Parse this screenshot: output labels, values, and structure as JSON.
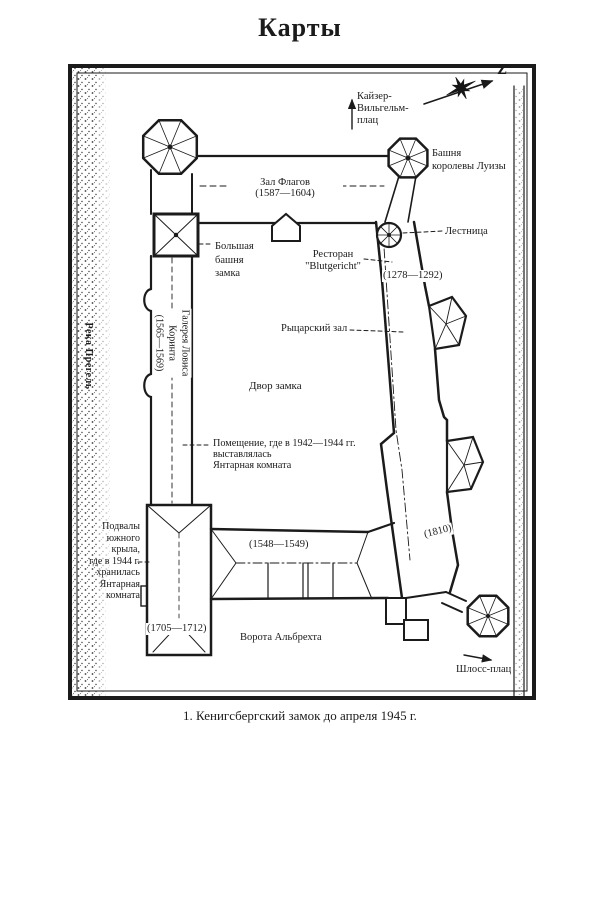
{
  "page": {
    "title": "Карты",
    "caption": "1. Кенигсбергский замок до апреля 1945 г."
  },
  "map": {
    "ink_color": "#1b1b1b",
    "paper_color": "#ffffff",
    "compass": {
      "north_letter": "Z"
    },
    "labels": {
      "kaiser_wilhelm_platz": "Кайзер-\nВильгельм-\nплац",
      "queen_louise_tower": "Башня\nкоролевы Луизы",
      "flags_hall": "Зал Флагов\n(1587—1604)",
      "big_castle_tower": "Большая\nбашня\nзамка",
      "staircase": "Лестница",
      "restaurant_blutgericht": "Ресторан\n\"Blutgericht\"",
      "years_1278_1292": "(1278—1292)",
      "knights_hall": "Рыцарский зал",
      "lovis_corinth_gallery": "Галерея Ловиса\nКоринта\n(1565—1569)",
      "castle_courtyard": "Двор замка",
      "amber_room_display": "Помещение, где в 1942—1944 гг.\nвыставлялась\nЯнтарная комната",
      "south_wing_basements": "Подвалы\nюжного\nкрыла,\nгде в 1944 г.\nхранилась\nЯнтарная\nкомната",
      "years_1548_1549": "(1548—1549)",
      "years_1810": "(1810)",
      "years_1705_1712": "(1705—1712)",
      "albrecht_gate": "Ворота Альбрехта",
      "schloss_platz": "Шлосс-плац",
      "pregel_river": "Река Прегель"
    }
  }
}
